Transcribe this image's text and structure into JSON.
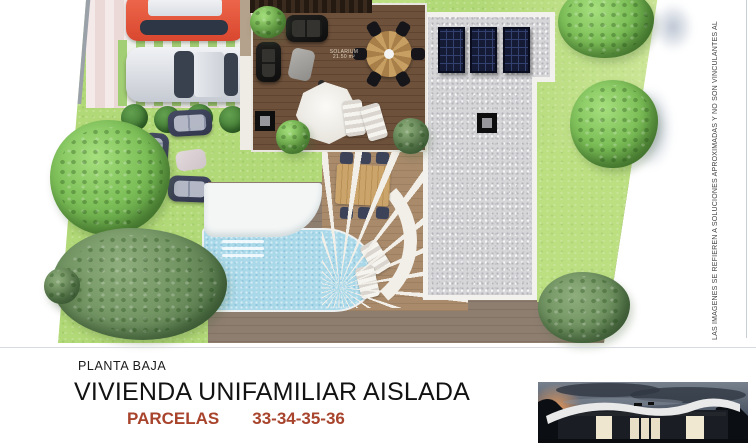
{
  "plan": {
    "solarium_label": "SOLARIUM",
    "solarium_area": "21.50 m²",
    "features": [
      "red-car",
      "silver-car",
      "parking-stripes",
      "hedge-bushes",
      "garden-lounge-set",
      "wood-deck-solarium",
      "pergola",
      "black-sofas",
      "round-dining-table",
      "deck-parasol",
      "sun-loungers",
      "deck-skylight",
      "louvered-terrace",
      "terrace-dining-table",
      "curved-walkway",
      "pool",
      "pool-steps",
      "garden-parasol",
      "gravel-roof",
      "solar-panels",
      "roof-skylight",
      "trees",
      "plot-boundary"
    ]
  },
  "disclaimer": {
    "text": "LAS IMÁGENES SE REFIEREN A SOLUCIONES APROXIMADAS Y NO SON VINCULANTES AL"
  },
  "footer": {
    "floor_label": "PLANTA BAJA",
    "title": "VIVIENDA UNIFAMILIAR AISLADA",
    "parcels_label": "PARCELAS",
    "parcels_numbers": "33-34-35-36"
  },
  "colors": {
    "grass": "#b2d977",
    "pool_water": "#a9d8e9",
    "deck_wood": "#6d513b",
    "patio_wood": "#8e7e70",
    "roof_gravel": "#d6d6d9",
    "solar_panel": "#151b34",
    "sofa_navy": "#3a3f55",
    "car_red": "#d9472f",
    "parcels_accent": "#a8432c"
  }
}
